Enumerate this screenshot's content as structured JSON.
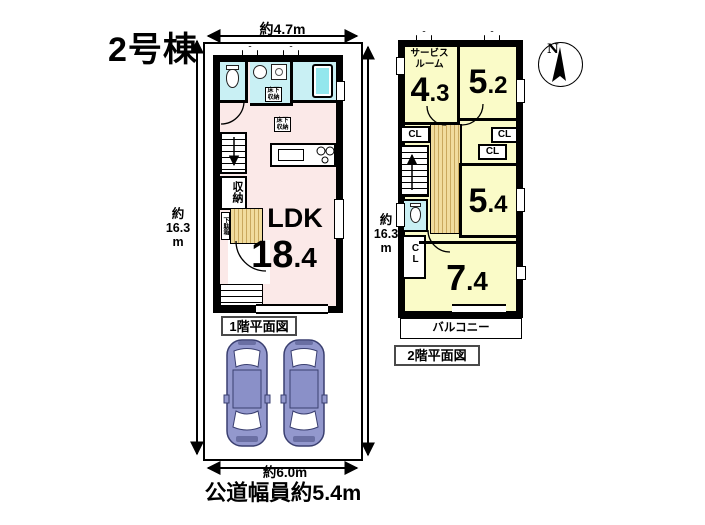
{
  "title": "2号棟",
  "site": {
    "dim_top": "約4.7m",
    "dim_side_a": "約",
    "dim_side_b": "16.3",
    "dim_side_c": "m",
    "dim_bottom": "約6.0m",
    "road_label": "公道幅員約5.4m"
  },
  "floor1": {
    "label": "1階平面図",
    "ldk_name": "LDK",
    "ldk_int": "18",
    "ldk_dec": ".4",
    "closet": "収納",
    "underfloor_a": "床下",
    "underfloor_b": "収納",
    "shoe_cabinet": "下駄箱"
  },
  "floor2": {
    "label": "2階平面図",
    "service_a": "サービス",
    "service_b": "ルーム",
    "r_service_int": "4",
    "r_service_dec": ".3",
    "r52_int": "5",
    "r52_dec": ".2",
    "r54_int": "5",
    "r54_dec": ".4",
    "r74_int": "7",
    "r74_dec": ".4",
    "cl": "CL",
    "balcony": "バルコニー"
  },
  "compass": {
    "north": "N"
  },
  "colors": {
    "wall": "#000000",
    "wet_room": "#c9f0f4",
    "tub": "#93e7ed",
    "ldk_pink": "#fbe9e8",
    "room_yellow": "#fafbc8",
    "hall_tan": "#f1dc9e",
    "car_body": "#9398cd"
  }
}
